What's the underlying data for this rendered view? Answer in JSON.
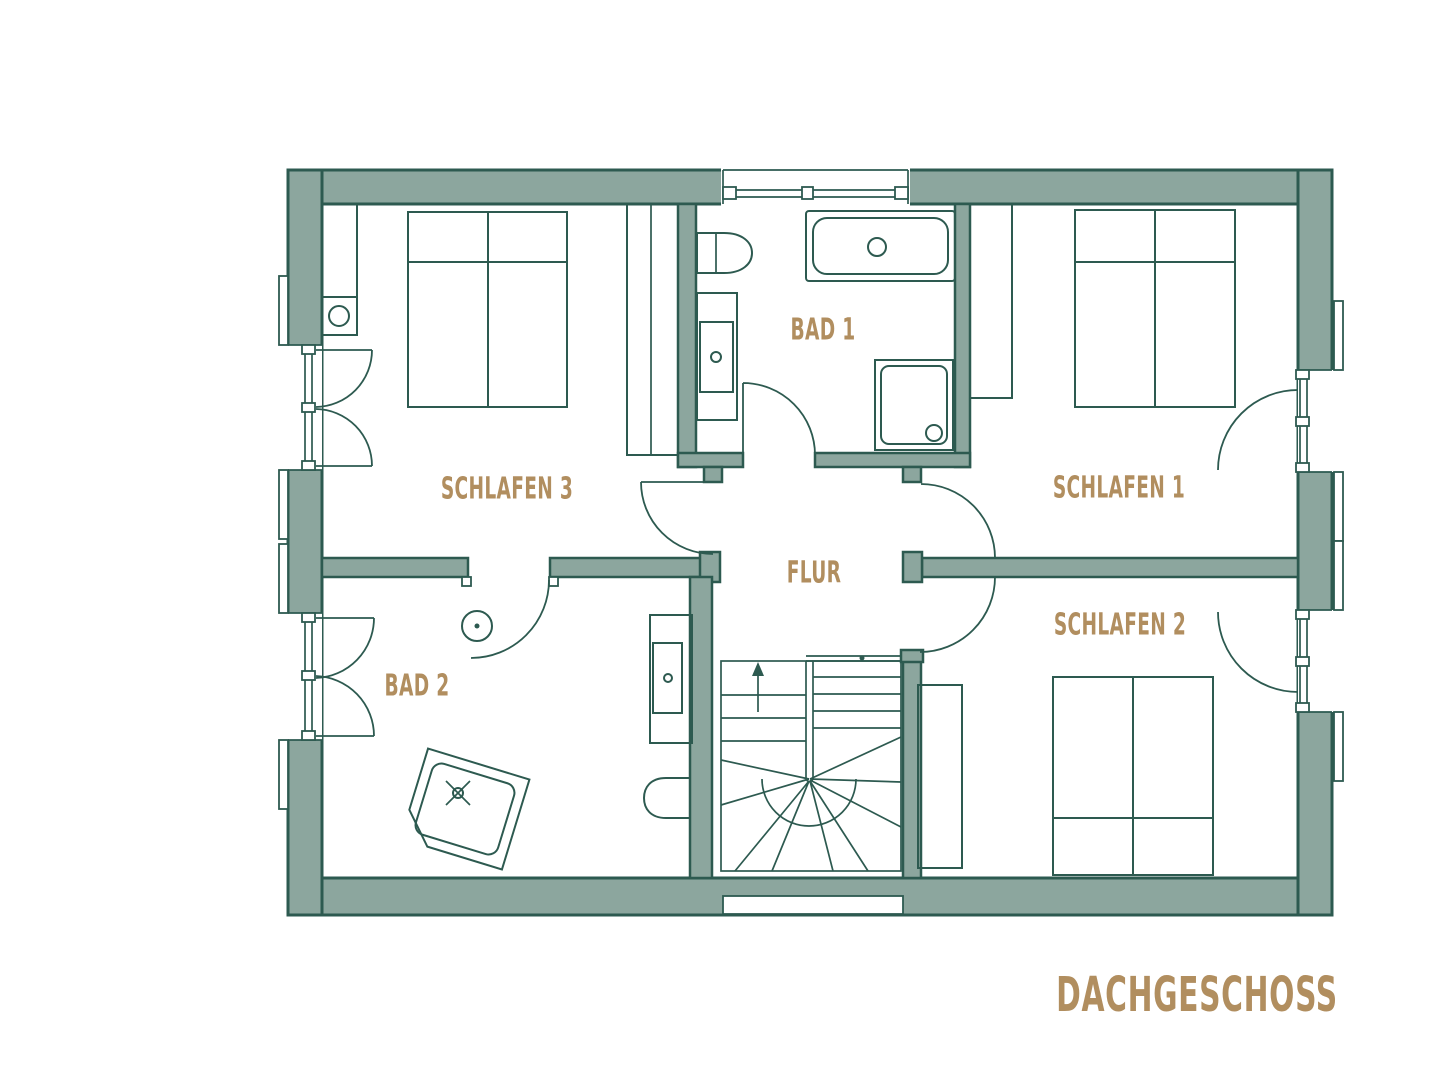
{
  "title": "DACHGESCHOSS",
  "rooms": {
    "schlafen3": {
      "label": "SCHLAFEN 3"
    },
    "bad1": {
      "label": "BAD 1"
    },
    "schlafen1": {
      "label": "SCHLAFEN 1"
    },
    "flur": {
      "label": "FLUR"
    },
    "schlafen2": {
      "label": "SCHLAFEN 2"
    },
    "bad2": {
      "label": "BAD 2"
    }
  },
  "colors": {
    "wall_fill": "#8CA69E",
    "line": "#2D5A50",
    "label": "#B18E5F",
    "background": "#FFFFFF"
  }
}
